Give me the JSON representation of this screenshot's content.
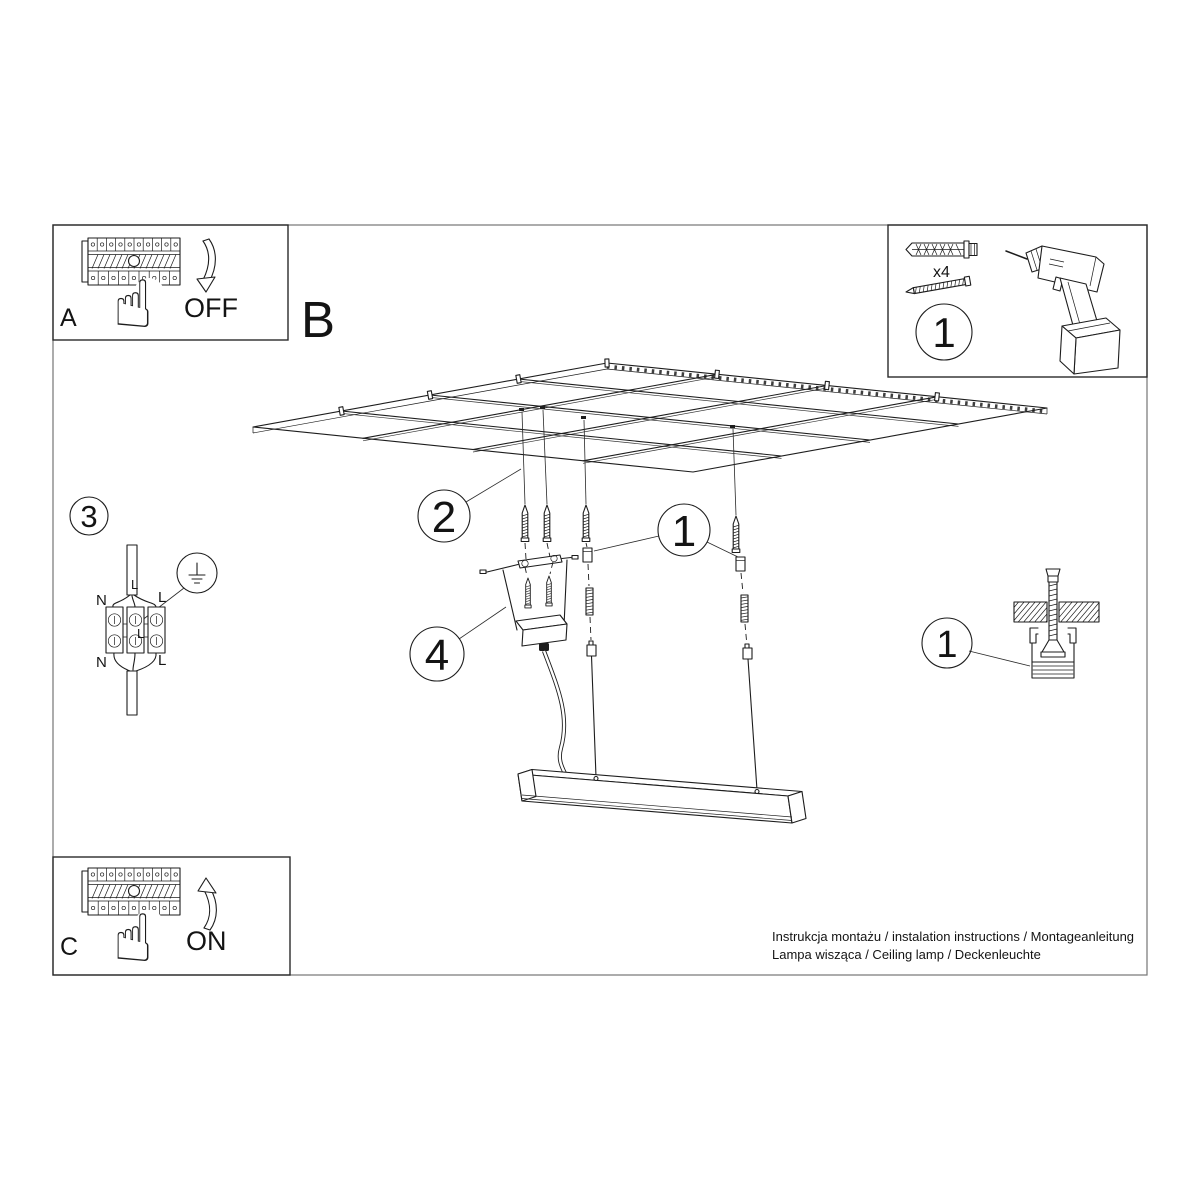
{
  "document": {
    "background": "#ffffff",
    "line_color": "#1d1d1d"
  },
  "steps": {
    "panel_a": {
      "label": "A",
      "action": "OFF"
    },
    "panel_b": {
      "label": "B"
    },
    "panel_c": {
      "label": "C",
      "action": "ON"
    }
  },
  "tools": {
    "step_number": "1",
    "anchor_quantity": "x4"
  },
  "wiring": {
    "step_number": "3",
    "labels": {
      "cable_top": "L",
      "top_left": "N",
      "top_right": "L",
      "center": "L",
      "bottom_left": "N",
      "bottom_right": "L"
    }
  },
  "callouts": {
    "ceiling_grid": "2",
    "suspension_cable": "1",
    "canopy": "4",
    "anchor_section": "1"
  },
  "icons": {
    "pointing_hand": "☝"
  },
  "footer": {
    "line1": "Instrukcja montażu / instalation instructions / Montageanleitung",
    "line2": "Lampa wisząca / Ceiling lamp / Deckenleuchte"
  }
}
